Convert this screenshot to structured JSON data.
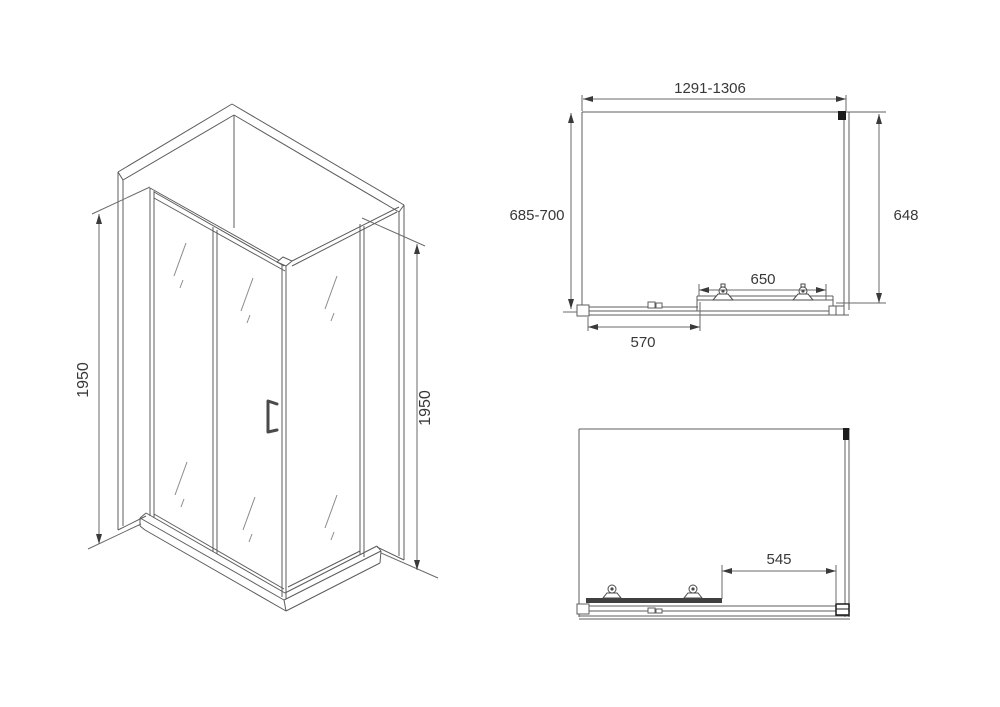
{
  "colors": {
    "background": "#ffffff",
    "line": "#5c5c5c",
    "dimension_line": "#6a6a6a",
    "text": "#383838",
    "dark_detail": "#1c1c1c"
  },
  "isometric_view": {
    "height_left": "1950",
    "height_right": "1950"
  },
  "plan_view_closed": {
    "width_range": "1291-1306",
    "depth_range": "685-700",
    "side_depth": "648",
    "sliding_door_width": "650",
    "fixed_panel_width": "570"
  },
  "plan_view_open": {
    "door_opening_width": "545"
  }
}
